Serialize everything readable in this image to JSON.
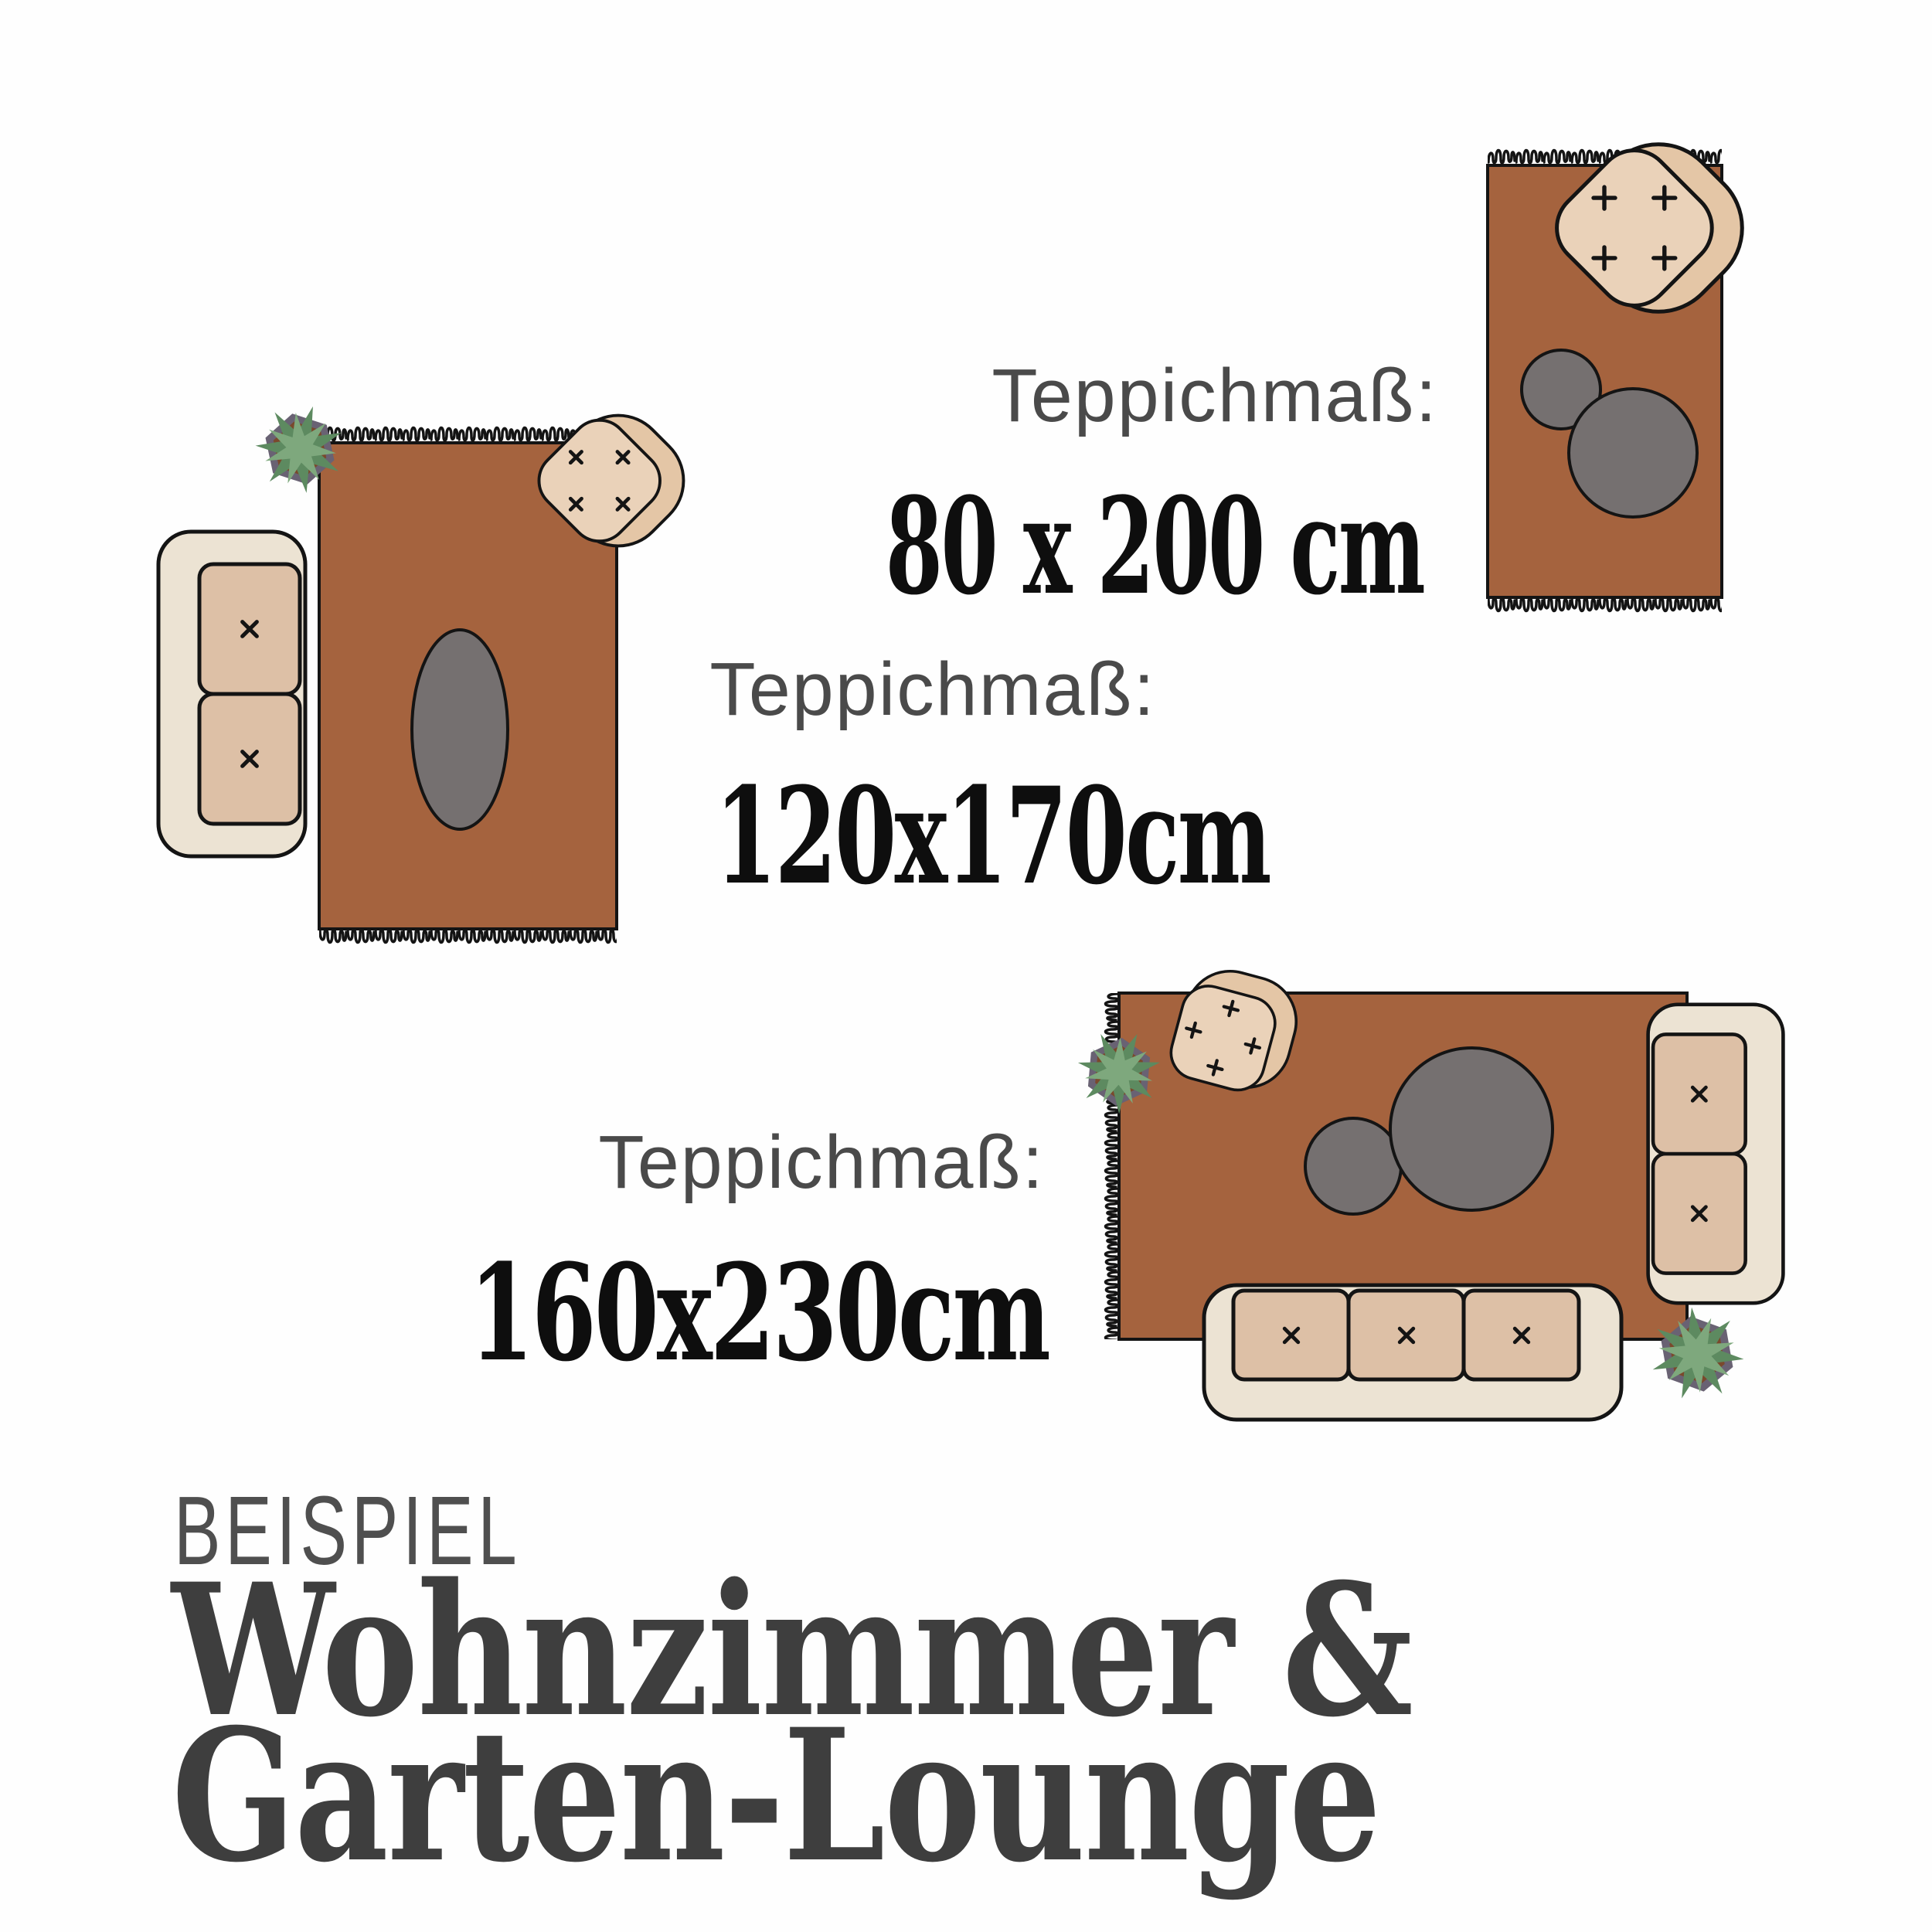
{
  "scenes": [
    {
      "id": "scene-80x200",
      "label": "Teppichmaß:",
      "size": "80 x 200 cm",
      "furniture": [
        "rug-with-fringe",
        "armchair",
        "side-table-small",
        "side-table-large"
      ]
    },
    {
      "id": "scene-120x170",
      "label": "Teppichmaß:",
      "size": "120x170cm",
      "furniture": [
        "rug-with-fringe",
        "two-seat-sofa",
        "armchair",
        "potted-plant",
        "oval-coffee-table"
      ]
    },
    {
      "id": "scene-160x230",
      "label": "Teppichmaß:",
      "size": "160x230cm",
      "furniture": [
        "rug-with-fringe",
        "armchair",
        "potted-plant",
        "potted-plant",
        "two-seat-sofa",
        "three-seat-sofa",
        "side-table-small",
        "side-table-large"
      ]
    }
  ],
  "footer": {
    "eyebrow": "BEISPIEL",
    "title_line1": "Wohnzimmer &",
    "title_line2": "Garten-Lounge"
  },
  "colors": {
    "background": "#fefefe",
    "rug": "#a5633e",
    "outline": "#141414",
    "coffee_table_gray": "#757070",
    "sofa_body": "#ece3d3",
    "sofa_cushion": "#ddc0a6",
    "armchair_back": "#e4c6a6",
    "armchair_seat": "#ead2b9",
    "plant_leaf_light": "#7ea87d",
    "plant_leaf_dark": "#5d8a60",
    "plant_pot": "#696273",
    "plant_soil": "#7a492c",
    "label_text": "#4a4a4a",
    "value_text": "#0e0e0e",
    "eyebrow_text": "#4f4f4f",
    "title_text": "#3e3e3e"
  }
}
